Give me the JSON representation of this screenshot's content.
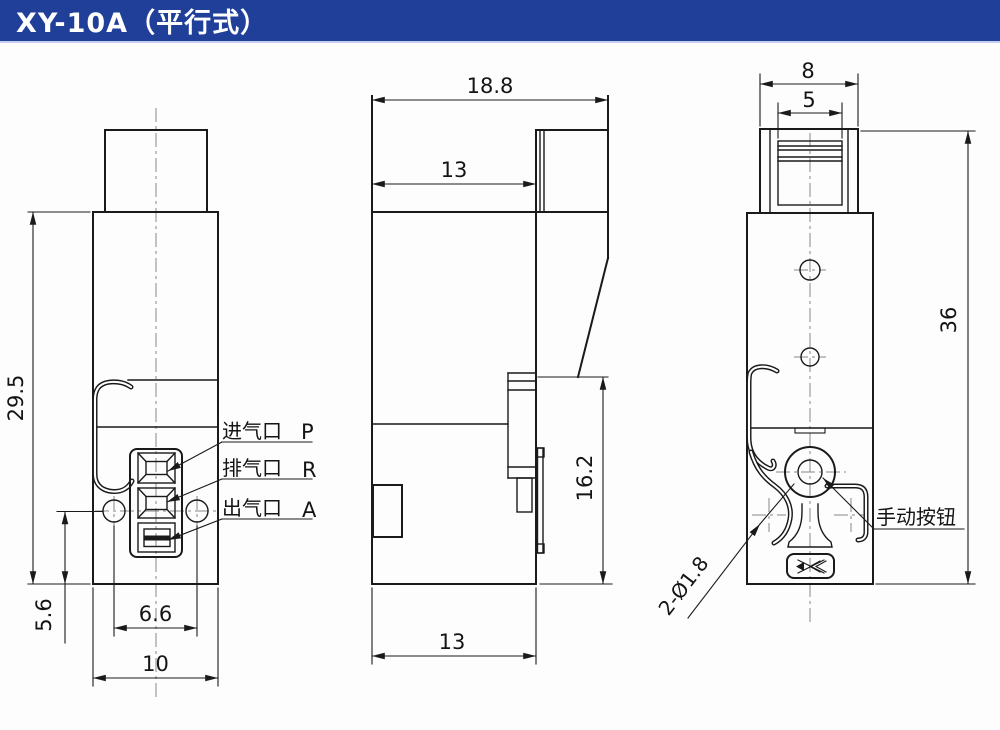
{
  "header": {
    "title": "XY-10A（平行式）"
  },
  "front_view": {
    "dim_height": "29.5",
    "dim_hole_offset": "5.6",
    "dim_hole_spacing": "6.6",
    "dim_width": "10",
    "ports": [
      {
        "name": "进气口",
        "code": "P"
      },
      {
        "name": "排气口",
        "code": "R"
      },
      {
        "name": "出气口",
        "code": "A"
      }
    ]
  },
  "side_view": {
    "dim_total_depth": "18.8",
    "dim_body_depth_top": "13",
    "dim_port_height": "16.2",
    "dim_body_depth_bottom": "13"
  },
  "back_view": {
    "dim_connector_outer": "8",
    "dim_connector_inner": "5",
    "dim_total_height": "36",
    "label_manual_button": "手动按钮",
    "label_mount_holes": "2-Ø1.8"
  },
  "colors": {
    "header_bg": "#1f3f99",
    "line": "#1a1a1a",
    "centerline": "#878787"
  }
}
